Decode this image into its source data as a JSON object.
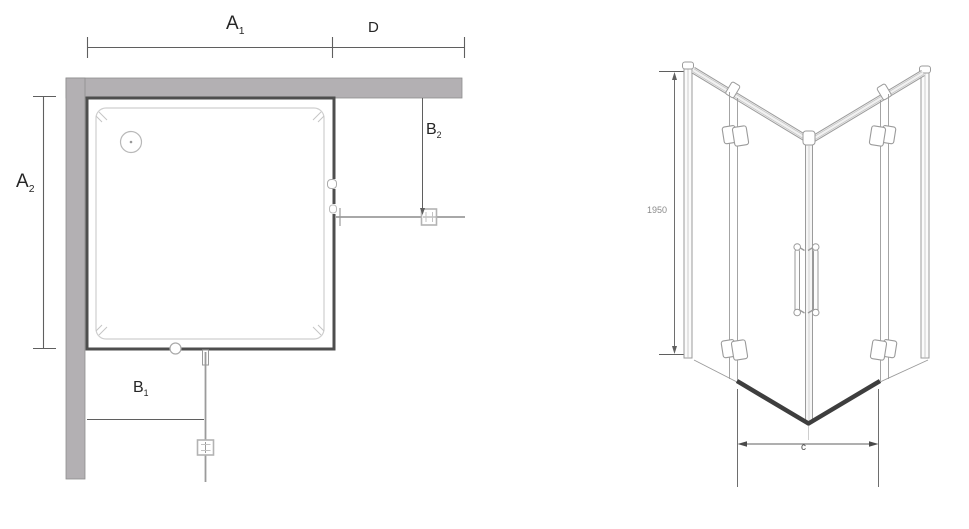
{
  "drawing": {
    "plan_view": {
      "dims": {
        "a1": {
          "base": "A",
          "sub": "1"
        },
        "d": {
          "base": "D",
          "sub": ""
        },
        "a2": {
          "base": "A",
          "sub": "2"
        },
        "b1": {
          "base": "B",
          "sub": "1"
        },
        "b2": {
          "base": "B",
          "sub": "2"
        }
      }
    },
    "front_view": {
      "dims": {
        "height": "1950",
        "width": "c"
      }
    },
    "colors": {
      "wall": "#b3b0b3",
      "tray_border": "#4e4e4e",
      "line": "#9b9b9b",
      "dark_rail": "#3e3e3e",
      "dim_line": "#5f5f5f",
      "label": "#262626",
      "small_label": "#8a8a8a"
    }
  }
}
